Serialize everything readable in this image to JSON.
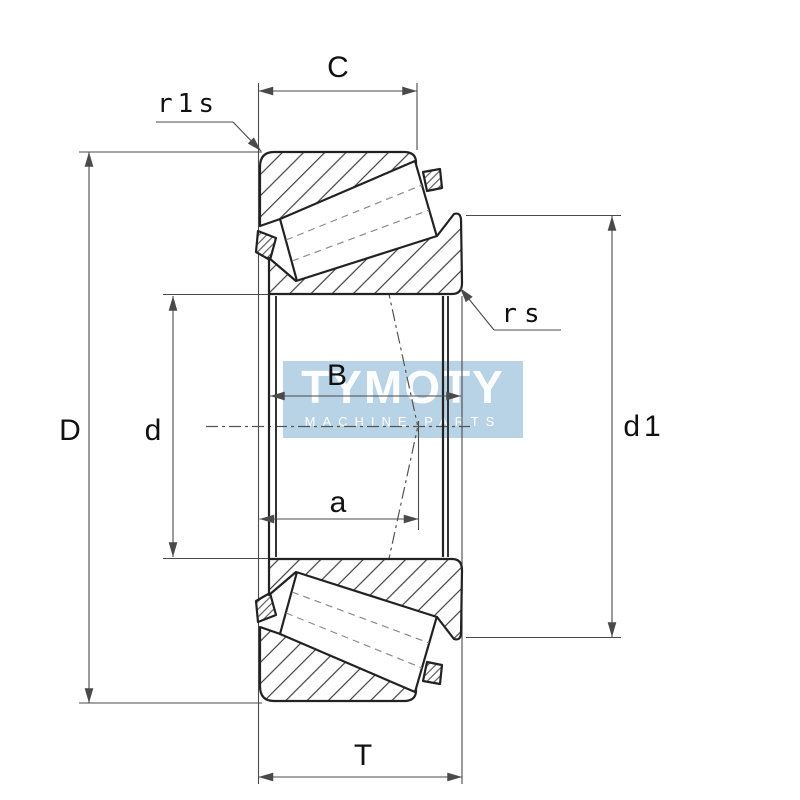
{
  "watermark": {
    "line1": "TYMOTY",
    "line2": "MACHINE PARTS"
  },
  "labels": {
    "outer_ring_width": "C",
    "outer_ring_corner_radius": "r1s",
    "inner_ring_corner_radius": "rs",
    "outside_diameter": "D",
    "bore_diameter": "d",
    "inner_ring_width": "B",
    "load_center_distance": "a",
    "rib_diameter": "d1",
    "total_width": "T"
  },
  "colors": {
    "structure_line": "#222222",
    "dimension_line": "#4a4a4a",
    "watermark_background": "#b2cfe4",
    "watermark_text": "#ffffff"
  }
}
